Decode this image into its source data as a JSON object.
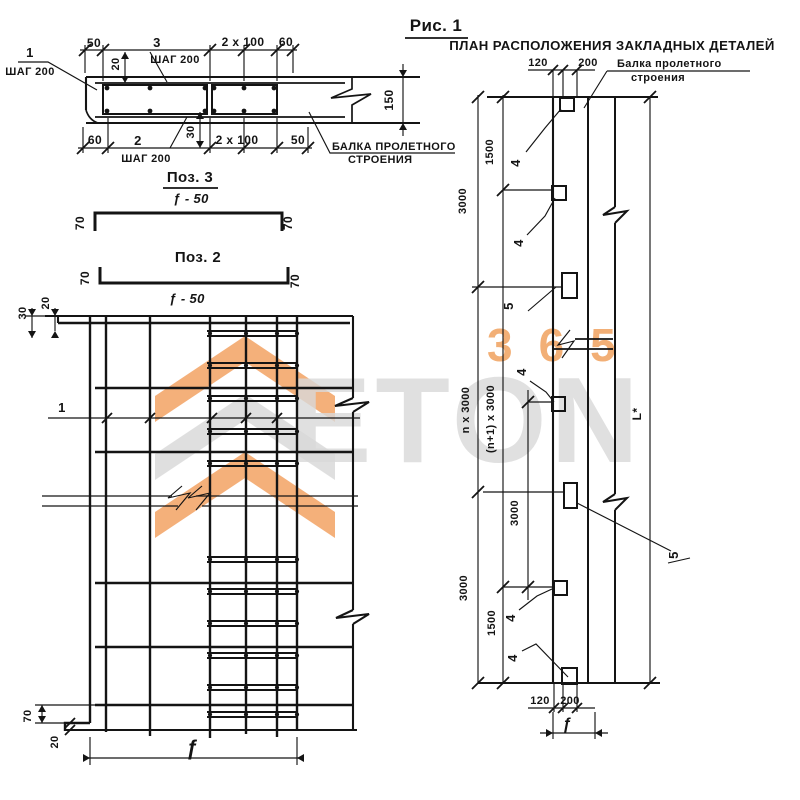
{
  "watermark": {
    "brand_top": "365",
    "brand_main": "ETON"
  },
  "figure_title": "Рис. 1",
  "section": {
    "pos1": {
      "num": "1",
      "step": "ШАГ 200"
    },
    "pos3": {
      "num": "3",
      "step": "ШАГ 200"
    },
    "pos2": {
      "num": "2",
      "step": "ШАГ 200"
    },
    "dims": {
      "top_50": "50",
      "top_2x100": "2 x 100",
      "top_60": "60",
      "cover_20": "20",
      "height_150": "150",
      "bot_60": "60",
      "cover_30": "30",
      "bot_2x100": "2 x 100",
      "bot_50": "50"
    },
    "beam_label": {
      "line1": "БАЛКА ПРОЛЕТНОГО",
      "line2": "СТРОЕНИЯ"
    }
  },
  "detail3": {
    "title": "Поз. 3",
    "length": "ƒ - 50",
    "end_left": "70",
    "end_right": "70"
  },
  "detail2": {
    "title": "Поз. 2",
    "length": "ƒ - 50",
    "end_left": "70",
    "end_right": "70"
  },
  "mesh": {
    "axis": "1",
    "dims": {
      "top_20": "20",
      "top_30": "30",
      "bot_70": "70",
      "bot_20": "20",
      "width_f": "ƒ"
    }
  },
  "plan": {
    "title": "ПЛАН РАСПОЛОЖЕНИЯ ЗАКЛАДНЫХ ДЕТАЛЕЙ",
    "beam_label": {
      "line1": "Балка пролетного",
      "line2": "строения"
    },
    "dims": {
      "top_120": "120",
      "top_200": "200",
      "seg_1500_top": "1500",
      "seg_3000_top": "3000",
      "n_3000": "n x 3000",
      "n1_3000": "(n+1) x 3000",
      "mid_3000": "3000",
      "seg_3000_bot": "3000",
      "seg_1500_bot": "1500",
      "bot_120": "120",
      "bot_200": "200",
      "width_f": "ƒ",
      "total": "L*"
    },
    "pos4": "4",
    "pos5": "5"
  }
}
